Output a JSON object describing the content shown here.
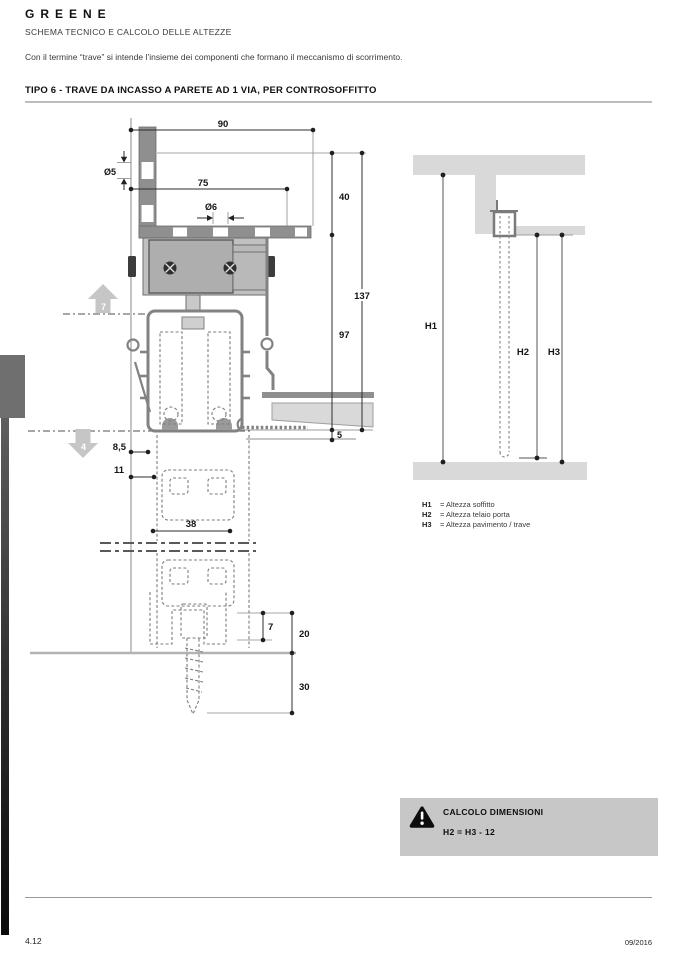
{
  "header": {
    "brand": "GREENE",
    "subtitle": "SCHEMA TECNICO E CALCOLO DELLE ALTEZZE",
    "intro": "Con il termine “trave” si intende l’insieme dei componenti che formano il meccanismo di scorrimento."
  },
  "section": {
    "title": "TIPO 6 - TRAVE DA INCASSO A PARETE AD 1 VIA, PER CONTROSOFFITTO"
  },
  "drawing": {
    "dims": {
      "top_width": "90",
      "hole_side": "Ø5",
      "plate_width": "75",
      "hole_top": "Ø6",
      "recess_height": "40",
      "total_height": "137",
      "track_height": "97",
      "ceiling_gap": "5",
      "offset_a": "8,5",
      "offset_b": "11",
      "guide_width": "38",
      "floor_gap": "7",
      "guide_height": "20",
      "anchor_depth": "30"
    },
    "arrows": {
      "up": "7",
      "down": "4"
    }
  },
  "heights": {
    "h1": "H1",
    "h2": "H2",
    "h3": "H3",
    "legend": [
      {
        "key": "H1",
        "text": "= Altezza soffitto"
      },
      {
        "key": "H2",
        "text": "= Altezza telaio porta"
      },
      {
        "key": "H3",
        "text": "= Altezza pavimento / trave"
      }
    ]
  },
  "calc": {
    "title": "CALCOLO DIMENSIONI",
    "formula": "H2 = H3 - 12"
  },
  "footer": {
    "page": "4.12",
    "date": "09/2016"
  },
  "colors": {
    "calc_box_bg": "#c7c7c7",
    "slab_gray": "#d9d9d9",
    "profile_gray": "#8f8f8f",
    "arrow_gray": "#c6c6c6"
  }
}
